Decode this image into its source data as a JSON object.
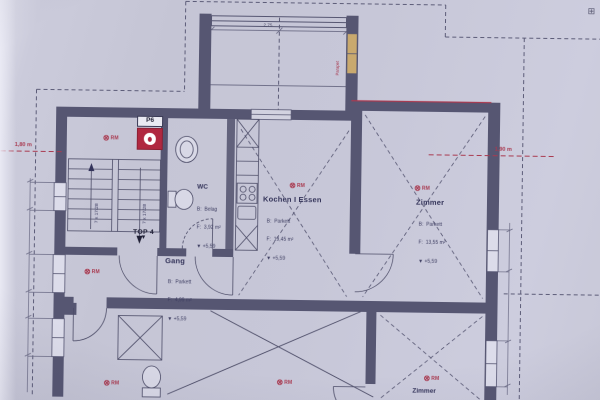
{
  "photo_plan": {
    "marker_label": "RM",
    "extinguisher_label": "P6",
    "unit_label": "TOP 4",
    "stair_flight_label": "7 x 17/28",
    "icons": {
      "rm_circle": "⊗",
      "survey_cross": "⊞",
      "down_arrow": "▼"
    },
    "dimensions": {
      "left_height": "1,80 m",
      "right_height": "1,90 m",
      "balcony_width": "2,75",
      "balcony_window_note": "Parapet"
    },
    "rooms": {
      "wc": {
        "name": "WC",
        "line1": "B:  Belag",
        "line2": "F:  3,92 m²",
        "line3": "▼ +5,59"
      },
      "gang": {
        "name": "Gang",
        "line1": "B:  Parkett",
        "line2": "F:  4,99 m²",
        "line3": "▼ +5,59"
      },
      "kochen": {
        "name": "Kochen I Essen",
        "line1": "B:  Parkett",
        "line2": "F:  19,45 m²",
        "line3": "▼ +5,59"
      },
      "zimmer_nord": {
        "name": "Zimmer",
        "line1": "B:  Parkett",
        "line2": "F:  13,55 m²",
        "line3": "▼ +5,59"
      },
      "zimmer_sued": {
        "name": "Zimmer"
      }
    },
    "colors": {
      "wall": "#565672",
      "line": "#4d4d68",
      "red": "#a93a50",
      "window_wood": "#c9a96e",
      "paper": "#c7c7d7"
    }
  }
}
